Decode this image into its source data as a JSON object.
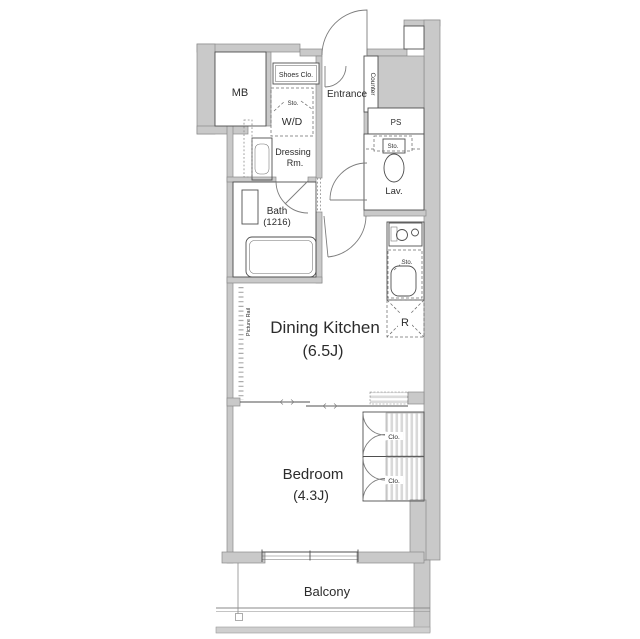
{
  "plan": {
    "title_hint": "apartment-floor-plan",
    "rooms": {
      "mb": "MB",
      "shoes_closet": "Shoes Clo.",
      "entrance": "Entrance",
      "counter": "Counter",
      "washer_dryer": "W/D",
      "wd_storage": "Sto.",
      "dressing_line1": "Dressing",
      "dressing_line2": "Rm.",
      "bath": "Bath",
      "bath_size": "(1216)",
      "lavatory": "Lav.",
      "lav_storage": "Sto.",
      "pipe_space": "PS",
      "dining_kitchen": "Dining Kitchen",
      "dining_kitchen_size": "(6.5J)",
      "kitchen_storage": "Sto.",
      "refrigerator": "R",
      "bedroom": "Bedroom",
      "bedroom_size": "(4.3J)",
      "closet_upper": "Clo.",
      "closet_lower": "Clo.",
      "balcony": "Balcony",
      "picture_rail": "Picture Rail"
    },
    "colors": {
      "wall_fill": "#c9c9c9",
      "wall_edge": "#8a8a8a",
      "line": "#4f4f4f",
      "text": "#2c2c2c",
      "background": "#ffffff"
    }
  }
}
